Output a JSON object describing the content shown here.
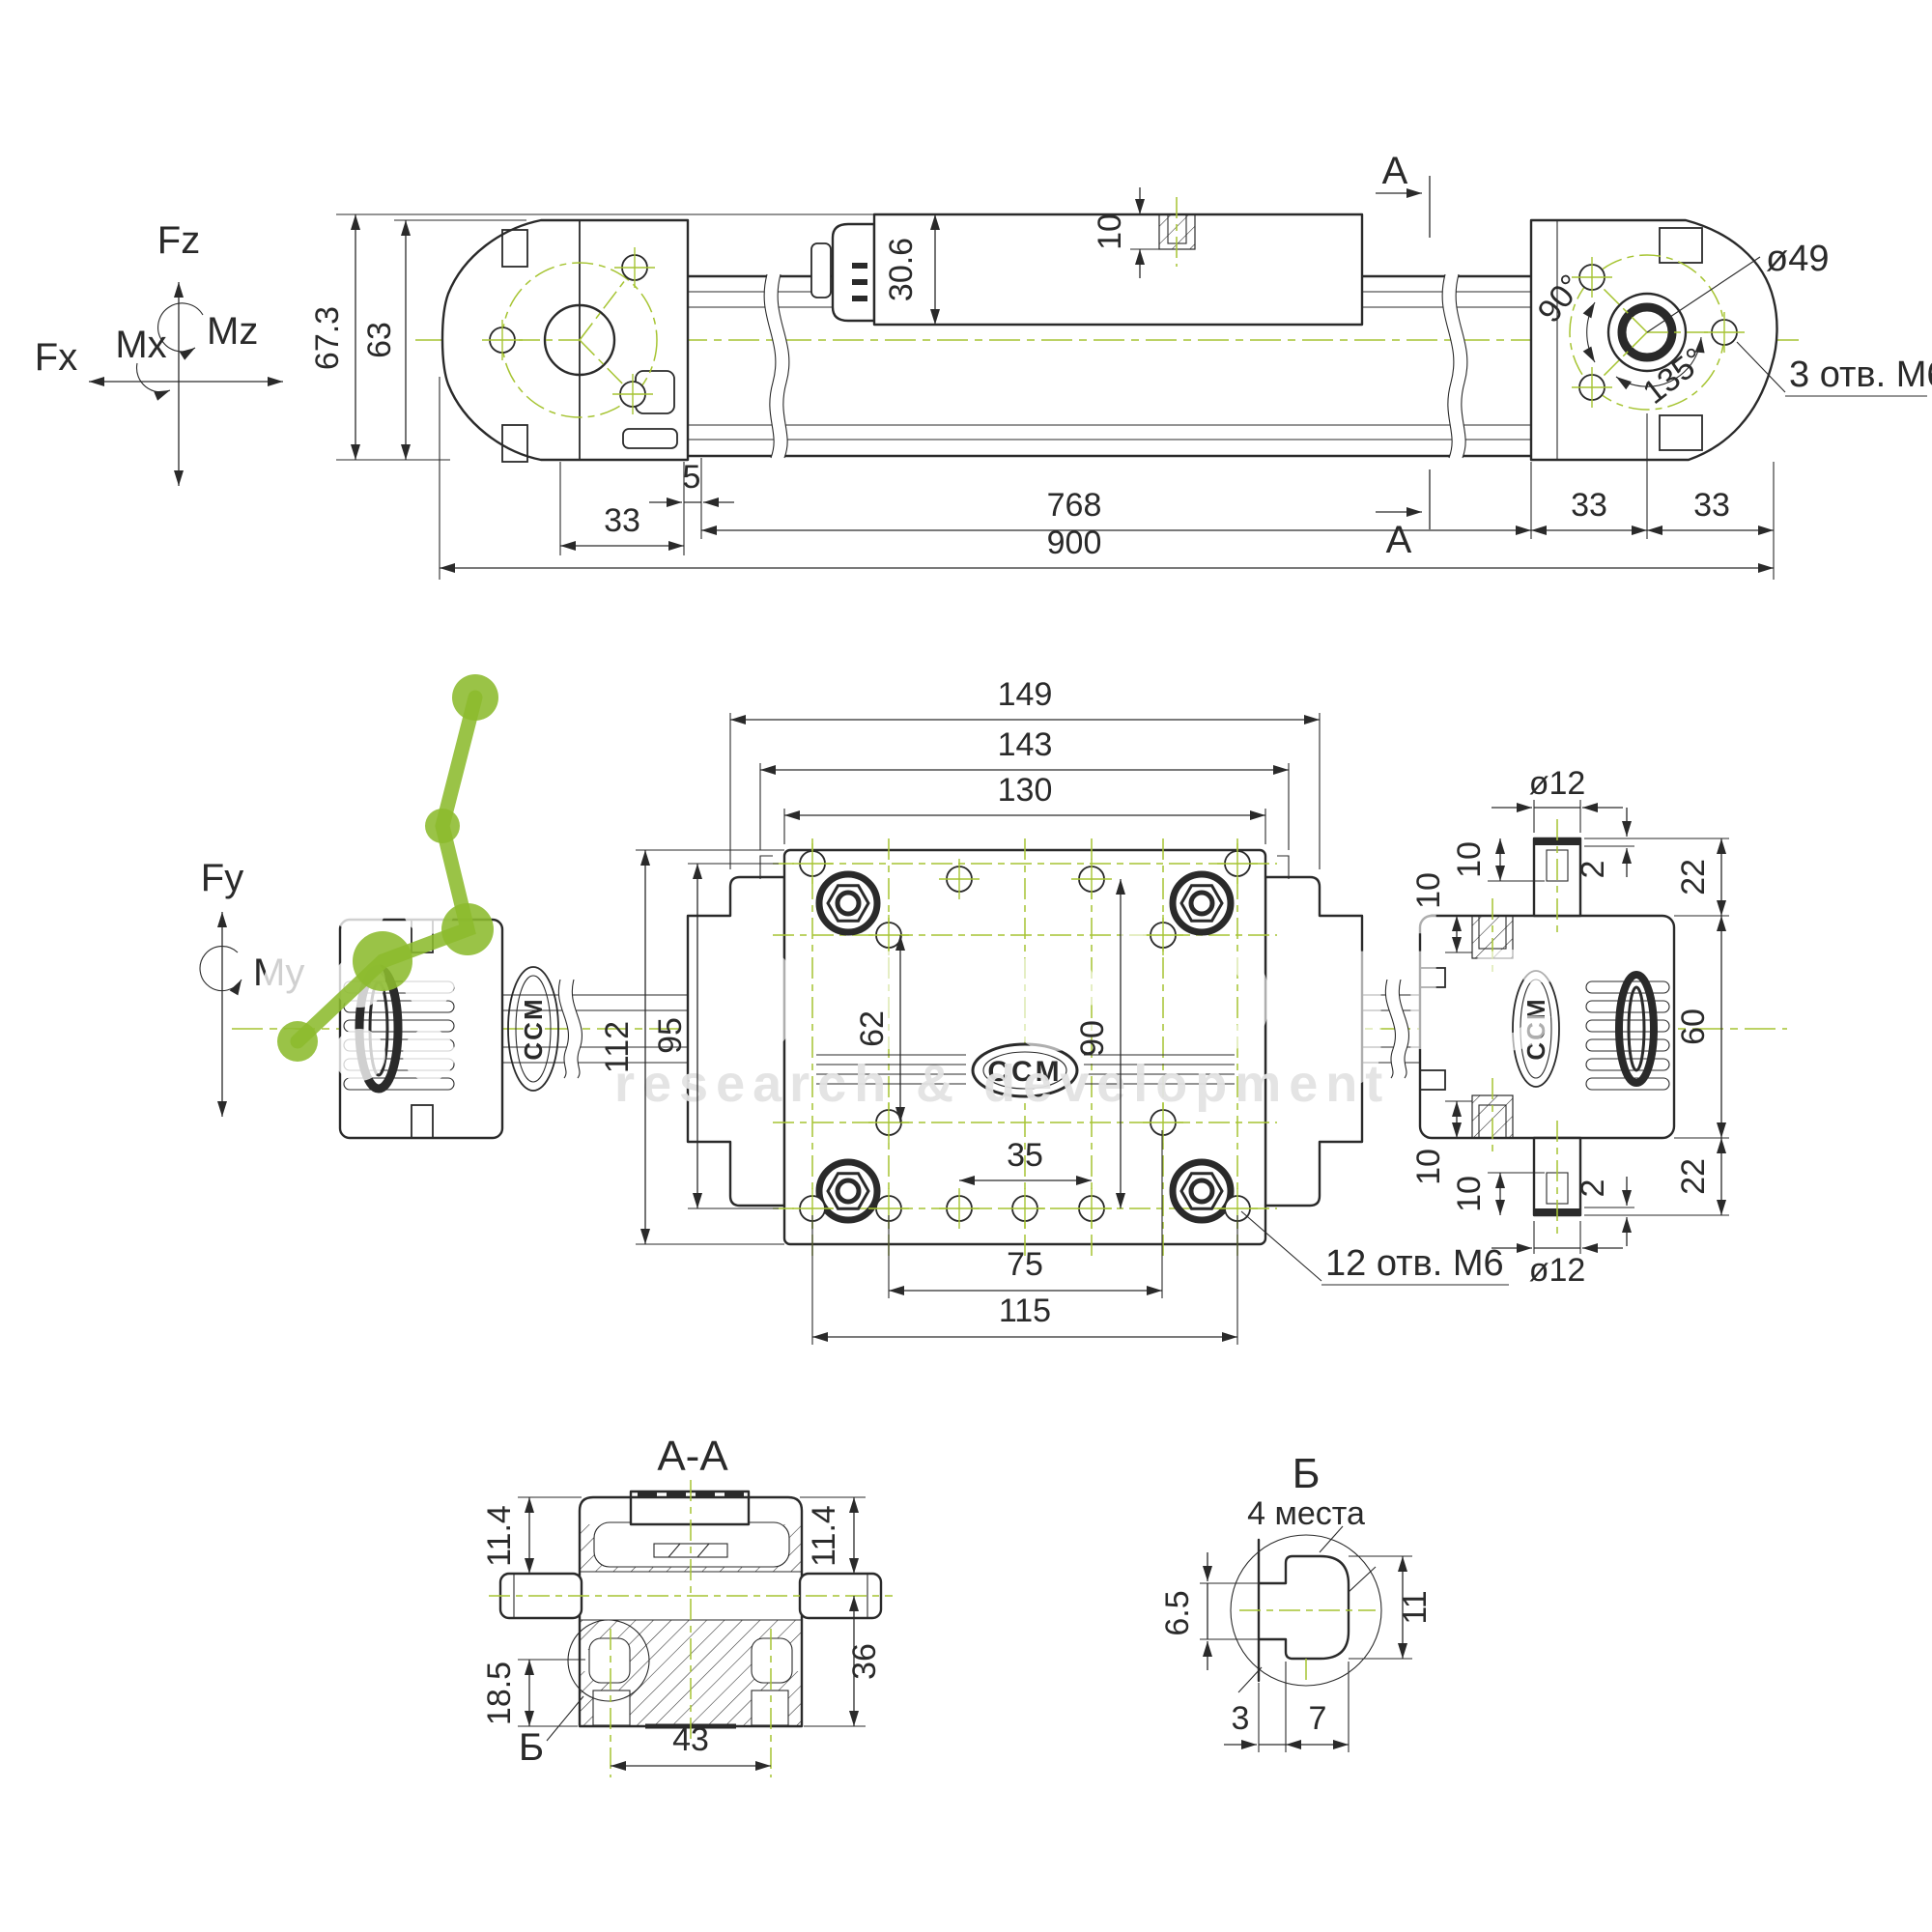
{
  "colors": {
    "ink": "#2a2a2a",
    "centerline_green": "#a6c432",
    "watermark_green": "#8cbb2d",
    "watermark_gray": "#e3e3e3"
  },
  "axes": {
    "fz": "Fz",
    "mz": "Mz",
    "mx": "Mx",
    "fx": "Fx",
    "fy": "Fy",
    "my": "My"
  },
  "side": {
    "h_total": "67.3",
    "h_cap": "63",
    "h_carriage": "30.6",
    "t_hole_depth": "10",
    "w_cap": "33",
    "w_gap": "5",
    "w_stroke": "768",
    "w_r1": "33",
    "w_r2": "33",
    "w_total": "900",
    "bolt_circle": "ø49",
    "ang90": "90°",
    "ang135": "135°",
    "holes": "3 отв. M6",
    "sec": "A"
  },
  "plan": {
    "w149": "149",
    "w143": "143",
    "w130": "130",
    "pin_d": "ø12",
    "pin_l": "10",
    "pin_s": "2",
    "e22a": "22",
    "h112": "112",
    "h95": "95",
    "h62": "62",
    "h90": "90",
    "hole10a": "10",
    "hole10b": "10",
    "w35": "35",
    "w75": "75",
    "w115": "115",
    "holes": "12 отв. M6",
    "pin_l2": "10",
    "pin_s2": "2",
    "pin_d2": "ø12",
    "e22b": "22",
    "h60": "60"
  },
  "section": {
    "title": "A-A",
    "d114l": "11.4",
    "d114r": "11.4",
    "d185": "18.5",
    "d36": "36",
    "d43": "43",
    "ref": "Б"
  },
  "detail": {
    "title": "Б",
    "subtitle": "4 места",
    "d65": "6.5",
    "d11": "11",
    "d3": "3",
    "d7": "7"
  },
  "watermark": {
    "brand": "purelogic",
    "tagline": "research & development"
  },
  "logo": {
    "text": "CCM"
  }
}
